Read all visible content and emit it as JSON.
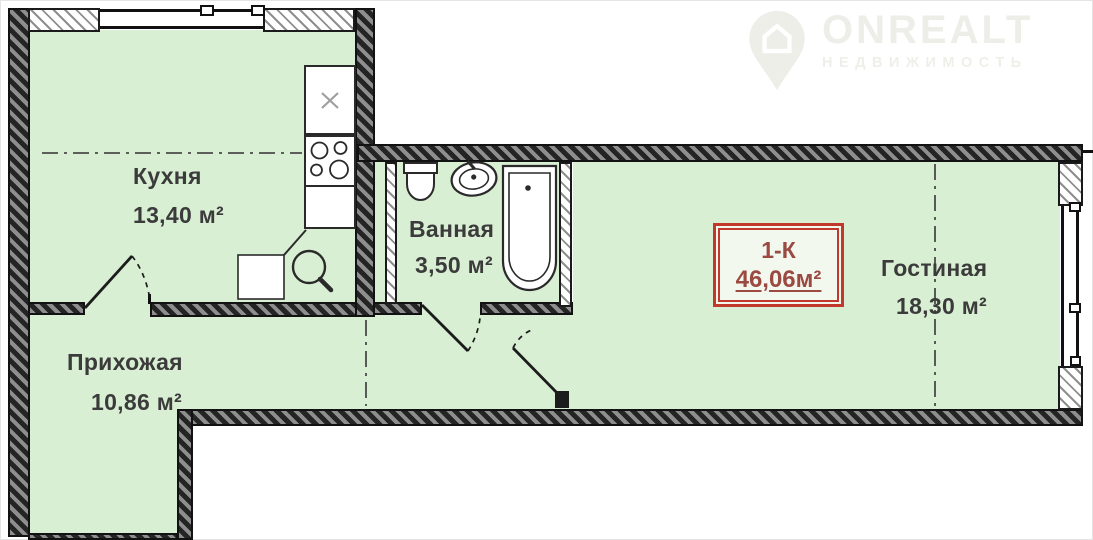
{
  "watermark": {
    "brand": "ONREALT",
    "subtitle": "НЕДВИЖИМОСТЬ"
  },
  "unit_card": {
    "type": "1-К",
    "area": "46,06м²"
  },
  "rooms": {
    "kitchen": {
      "name": "Кухня",
      "area": "13,40 м²"
    },
    "bathroom": {
      "name": "Ванная",
      "area": "3,50 м²"
    },
    "living": {
      "name": "Гостиная",
      "area": "18,30 м²"
    },
    "hallway": {
      "name": "Прихожая",
      "area": "10,86 м²"
    }
  },
  "icons": {
    "watermark": "location-pin-house-icon",
    "kitchen": [
      "counter-sink-icon",
      "stove-icon",
      "round-sink-icon"
    ],
    "bathroom": [
      "toilet-icon",
      "washbasin-icon",
      "bathtub-icon"
    ]
  },
  "colors": {
    "floor_green": "#d9efd3",
    "wall_dark": "#242424",
    "card_border_red": "#c0392b",
    "card_text_red": "#9b4a42",
    "label_gray": "#3b3b3b",
    "watermark_gray": "#eeeee9"
  }
}
